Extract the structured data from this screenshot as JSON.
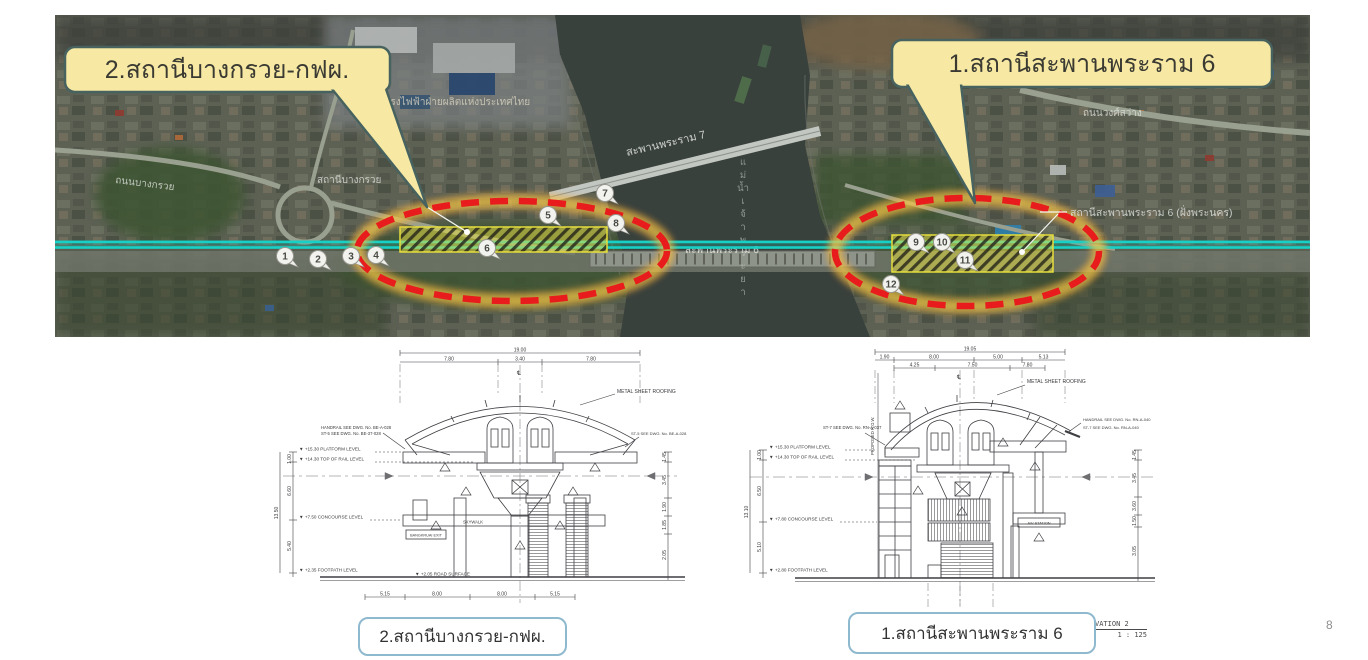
{
  "page": {
    "number": "8"
  },
  "map": {
    "callouts": [
      {
        "label": "2.สถานีบางกรวย-กฟผ."
      },
      {
        "label": "1.สถานีสะพานพระราม 6"
      }
    ],
    "labels": {
      "road_bangkruai": "ถนนบางกรวย",
      "station_bangkruai": "สถานีบางกรวย",
      "egat": "โรงไฟฟ้าฝ่ายผลิตแห่งประเทศไทย",
      "bridge_rama7": "สะพานพระราม 7",
      "bridge_rama6": "สะพานพระราม 6",
      "river": "แม่น้ำเจ้าพระยา",
      "road_wongsawang": "ถนนวงศ์สว่าง",
      "station_rama6_bank": "สถานีสะพานพระราม 6 (ฝั่งพระนคร)"
    },
    "markers": [
      "1",
      "2",
      "3",
      "4",
      "5",
      "6",
      "7",
      "8",
      "9",
      "10",
      "11",
      "12"
    ],
    "colors": {
      "route_line": "#17d1c6",
      "zone_outline": "#e81c1c",
      "zone_glow": "#f0a83c",
      "hatch_fill": "#e6de3c",
      "callout_fill": "#f7e9a4",
      "callout_border": "#47625f"
    }
  },
  "drawings": {
    "left": {
      "caption": "2.สถานีบางกรวย-กฟผ.",
      "top_dims": {
        "total": "19.00",
        "segments": [
          "7.80",
          "3.40",
          "7.80"
        ]
      },
      "bottom_dims": [
        "5.15",
        "8.00",
        "8.00",
        "5.15"
      ],
      "levels": [
        "▼ +15.30  PLATFORM LEVEL",
        "▼ +14.30  TOP OF RAIL LEVEL",
        "▼ +7.50  CONCOURSE LEVEL",
        "▼ +2.35  FOOTPATH LEVEL"
      ],
      "road_surface": "▼ +2.05  ROAD SURFACE",
      "side_dims_left": [
        "1.00",
        "6.60",
        "5.40"
      ],
      "side_total_left": "13.50",
      "side_dims_right": [
        "1.45",
        "3.45",
        "1.90",
        "1.85",
        "2.05"
      ],
      "notes": {
        "roofing": "METAL SHEET ROOFING",
        "handrail": "HANDRAIL SEE DWG. No. BE-A-028",
        "st_left": "ST-5 SEE DWG. No. BE-37-028",
        "st_right": "ST-5 SEE DWG. No. BE-A-028",
        "skywalk": "SKYWALK",
        "exit_box": "BANGKRUAI EXIT",
        "centerline": "℄"
      }
    },
    "right": {
      "caption": "1.สถานีสะพานพระราม 6",
      "top_dims": {
        "total": "19.05",
        "segments": [
          "1.90",
          "8.00",
          "5.00",
          "5.13"
        ],
        "sub": [
          "4.25",
          "7.50",
          "7.80"
        ]
      },
      "levels": [
        "▼ +15.30  PLATFORM LEVEL",
        "▼ +14.30  TOP OF RAIL LEVEL",
        "▼ +7.80  CONCOURSE LEVEL",
        "▼ +2.80  FOOTPATH LEVEL"
      ],
      "side_dims_left": [
        "1.00",
        "6.50",
        "5.10"
      ],
      "side_total_left": "13.10",
      "side_dims_right": [
        "1.45",
        "3.45",
        "3.60",
        "1.50",
        "3.05"
      ],
      "notes": {
        "roofing": "METAL SHEET ROOFING",
        "handrail": "HANDRAIL SEE DWG. No. RN-A-040",
        "st_right": "ST-7 SEE DWG. No. RN-A-040",
        "st_left": "ST-7 SEE DWG. No. RN-A-037",
        "row": "PROPOSED R.O.W.",
        "station_box": "A/V STATION",
        "centerline": "℄"
      },
      "title_block": {
        "line1": "VATION    2",
        "line2": "1 : 125"
      }
    }
  }
}
